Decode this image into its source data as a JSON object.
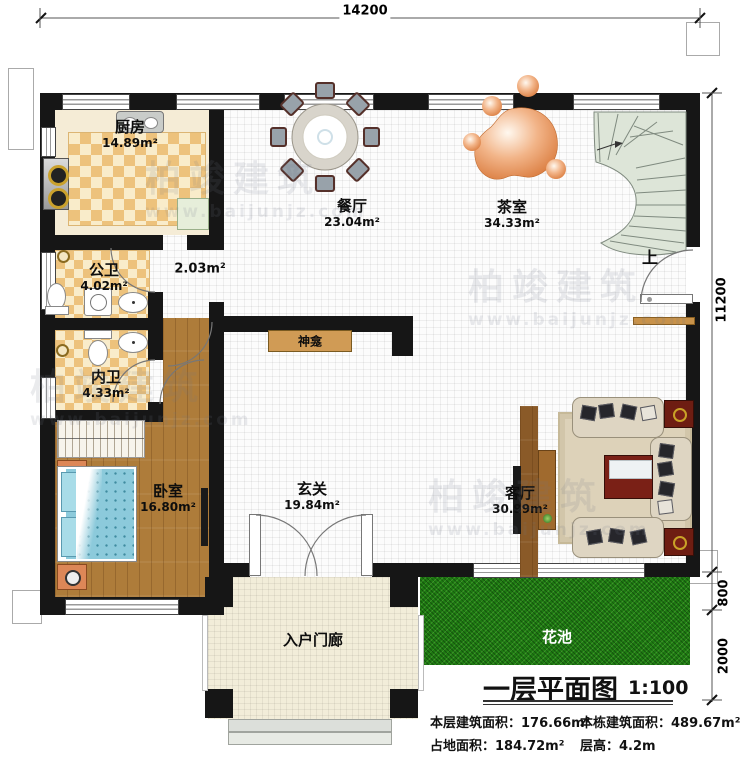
{
  "plan_title": {
    "text": "一层平面图",
    "scale": "1:100"
  },
  "stats": [
    {
      "label": "本层建筑面积：",
      "value": "176.66m²"
    },
    {
      "label": "本栋建筑面积：",
      "value": "489.67m²"
    },
    {
      "label": "占地面积：",
      "value": "184.72m²"
    },
    {
      "label": "层高：",
      "value": "4.2m"
    }
  ],
  "dimensions": {
    "top": "14200",
    "right": "11200",
    "flower_bed": "800",
    "yard": "2000"
  },
  "rooms": [
    {
      "name": "厨房",
      "area": "14.89m²"
    },
    {
      "name": "餐厅",
      "area": "23.04m²"
    },
    {
      "name": "茶室",
      "area": "34.33m²"
    },
    {
      "name": "公卫",
      "area": "4.02m²"
    },
    {
      "name": "内卫",
      "area": "4.33m²"
    },
    {
      "name": "卧室",
      "area": "16.80m²"
    },
    {
      "name": "玄关",
      "area": "19.84m²"
    },
    {
      "name": "客厅",
      "area": "30.99m²"
    },
    {
      "name": "入户门廊",
      "area": ""
    },
    {
      "name": "花池",
      "area": ""
    }
  ],
  "annotations": {
    "corridor_area": "2.03m²",
    "shrine": "神龛",
    "stairs_up": "上"
  },
  "watermark": {
    "brand": "柏竣建筑",
    "url": "www.baijunjz.com"
  },
  "colors": {
    "wall": "#161616",
    "tile": "#edc27c",
    "wood": "#ae7c3a",
    "grass": "#1e7a12",
    "stair": "#dde5d8",
    "sofa": "#ded5c2",
    "table_red": "#7a2016",
    "bed": "#84c7d8"
  }
}
